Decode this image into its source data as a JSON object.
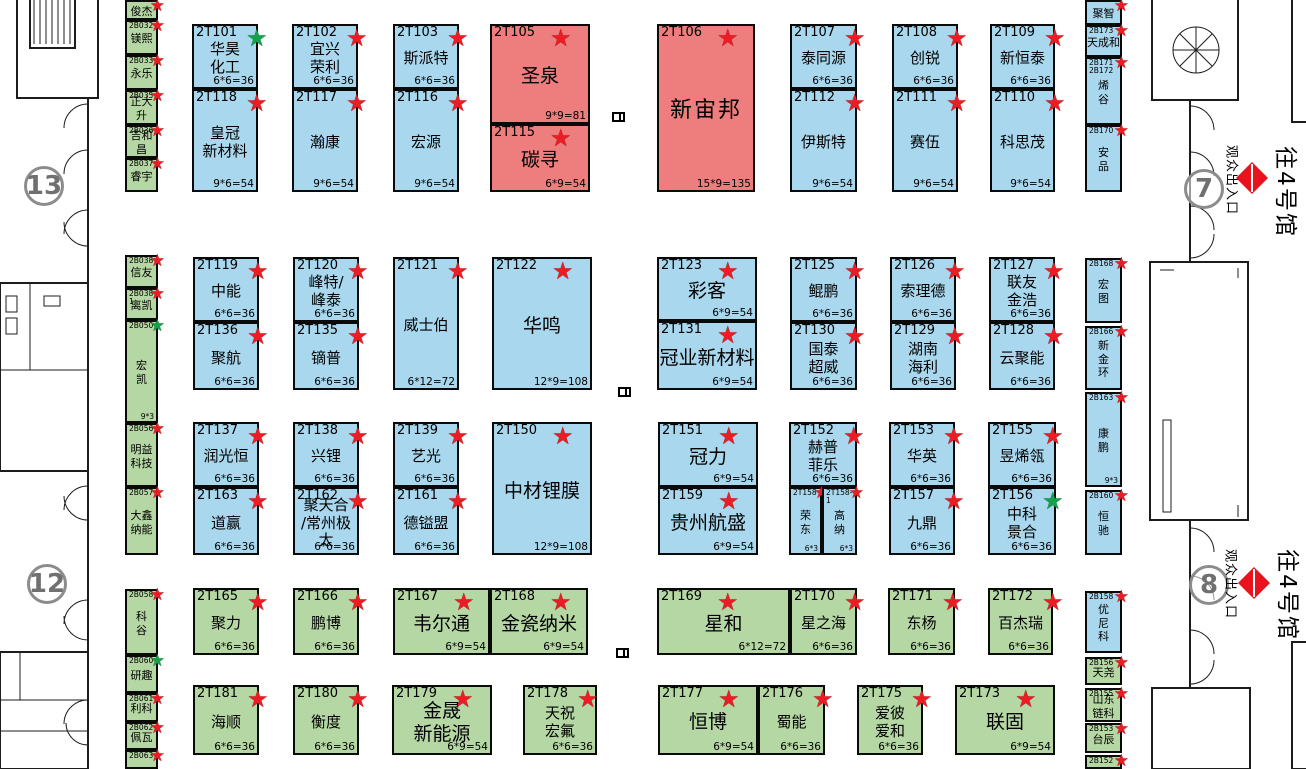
{
  "colors": {
    "booth_blue": "#a9d8ee",
    "booth_red": "#ee7d7d",
    "booth_green": "#b5d7a4",
    "star_red": "#ed1c24",
    "star_green": "#13a24a",
    "wall": "#1c1c1c",
    "gate_gray": "#8c8c8c",
    "exit_diamond_red": "#e8131d"
  },
  "icons": {
    "star": "★",
    "exit_diamond": "diamond-with-line",
    "pillar": "column-marker"
  },
  "labels": {
    "exit": "观众出入口",
    "hall": "往4号馆"
  },
  "gates": [
    {
      "num": "13",
      "cx": 44,
      "cy": 186
    },
    {
      "num": "12",
      "cx": 47,
      "cy": 584
    },
    {
      "num": "7",
      "cx": 1204,
      "cy": 189,
      "exit": true,
      "exit_cx": 1233,
      "exit_cy": 180,
      "dia_cx": 1252,
      "dia_cy": 178,
      "hall_cx": 1288,
      "hall_cy": 192
    },
    {
      "num": "8",
      "cx": 1209,
      "cy": 585,
      "exit": true,
      "exit_cx": 1232,
      "exit_cy": 584,
      "dia_cx": 1254,
      "dia_cy": 583,
      "hall_cx": 1290,
      "hall_cy": 595
    }
  ],
  "pillars": [
    {
      "x": 612,
      "y": 112
    },
    {
      "x": 618,
      "y": 387
    },
    {
      "x": 616,
      "y": 648
    }
  ],
  "booths": [
    {
      "id": "2T101",
      "name": "华昊\n化工",
      "size": "6*6=36",
      "color": "blue",
      "star": "green",
      "x": 192,
      "y": 24,
      "w": 66,
      "h": 65
    },
    {
      "id": "2T118",
      "name": "皇冠\n新材料",
      "size": "9*6=54",
      "color": "blue",
      "star": "red",
      "x": 192,
      "y": 89,
      "w": 66,
      "h": 103
    },
    {
      "id": "2T102",
      "name": "宜兴\n荣利",
      "size": "6*6=36",
      "color": "blue",
      "star": "red",
      "x": 292,
      "y": 24,
      "w": 66,
      "h": 65
    },
    {
      "id": "2T117",
      "name": "瀚康",
      "size": "9*6=54",
      "color": "blue",
      "star": "red",
      "x": 292,
      "y": 89,
      "w": 66,
      "h": 103
    },
    {
      "id": "2T103",
      "name": "斯派特",
      "size": "6*6=36",
      "color": "blue",
      "star": "red",
      "x": 393,
      "y": 24,
      "w": 66,
      "h": 65
    },
    {
      "id": "2T116",
      "name": "宏源",
      "size": "9*6=54",
      "color": "blue",
      "star": "red",
      "x": 393,
      "y": 89,
      "w": 66,
      "h": 103
    },
    {
      "id": "2T105",
      "name": "圣泉",
      "size": "9*9=81",
      "color": "red",
      "star": "red",
      "x": 490,
      "y": 24,
      "w": 100,
      "h": 100
    },
    {
      "id": "2T115",
      "name": "碳寻",
      "size": "6*9=54",
      "color": "red",
      "star": "red",
      "x": 490,
      "y": 124,
      "w": 100,
      "h": 68
    },
    {
      "id": "2T106",
      "name": "新宙邦",
      "size": "15*9=135",
      "color": "red",
      "star": "red",
      "x": 657,
      "y": 24,
      "w": 98,
      "h": 168
    },
    {
      "id": "2T107",
      "name": "泰同源",
      "size": "6*6=36",
      "color": "blue",
      "star": "red",
      "x": 790,
      "y": 24,
      "w": 67,
      "h": 65
    },
    {
      "id": "2T112",
      "name": "伊斯特",
      "size": "9*6=54",
      "color": "blue",
      "star": "red",
      "x": 790,
      "y": 89,
      "w": 67,
      "h": 103
    },
    {
      "id": "2T108",
      "name": "创锐",
      "size": "6*6=36",
      "color": "blue",
      "star": "red",
      "x": 892,
      "y": 24,
      "w": 66,
      "h": 65
    },
    {
      "id": "2T111",
      "name": "赛伍",
      "size": "9*6=54",
      "color": "blue",
      "star": "red",
      "x": 892,
      "y": 89,
      "w": 66,
      "h": 103
    },
    {
      "id": "2T109",
      "name": "新恒泰",
      "size": "6*6=36",
      "color": "blue",
      "star": "red",
      "x": 990,
      "y": 24,
      "w": 65,
      "h": 65
    },
    {
      "id": "2T110",
      "name": "科思茂",
      "size": "9*6=54",
      "color": "blue",
      "star": "red",
      "x": 990,
      "y": 89,
      "w": 65,
      "h": 103
    },
    {
      "id": "2T119",
      "name": "中能",
      "size": "6*6=36",
      "color": "blue",
      "star": "red",
      "x": 193,
      "y": 257,
      "w": 66,
      "h": 65
    },
    {
      "id": "2T136",
      "name": "聚航",
      "size": "6*6=36",
      "color": "blue",
      "star": "red",
      "x": 193,
      "y": 322,
      "w": 66,
      "h": 68
    },
    {
      "id": "2T120",
      "name": "峰特/\n峰泰",
      "size": "6*6=36",
      "color": "blue",
      "star": "red",
      "x": 293,
      "y": 257,
      "w": 66,
      "h": 65
    },
    {
      "id": "2T135",
      "name": "镝普",
      "size": "6*6=36",
      "color": "blue",
      "star": "red",
      "x": 293,
      "y": 322,
      "w": 66,
      "h": 68
    },
    {
      "id": "2T121",
      "name": "威士伯",
      "size": "6*12=72",
      "color": "blue",
      "star": "red",
      "x": 393,
      "y": 257,
      "w": 66,
      "h": 133
    },
    {
      "id": "2T122",
      "name": "华鸣",
      "size": "12*9=108",
      "color": "blue",
      "star": "red",
      "x": 492,
      "y": 257,
      "w": 100,
      "h": 133
    },
    {
      "id": "2T123",
      "name": "彩客",
      "size": "6*9=54",
      "color": "blue",
      "star": "red",
      "x": 657,
      "y": 257,
      "w": 100,
      "h": 64
    },
    {
      "id": "2T131",
      "name": "冠业新材料",
      "size": "6*9=54",
      "color": "blue",
      "star": "red",
      "x": 657,
      "y": 321,
      "w": 100,
      "h": 69
    },
    {
      "id": "2T125",
      "name": "鲲鹏",
      "size": "6*6=36",
      "color": "blue",
      "star": "red",
      "x": 790,
      "y": 257,
      "w": 67,
      "h": 65
    },
    {
      "id": "2T130",
      "name": "国泰\n超威",
      "size": "6*6=36",
      "color": "blue",
      "star": "red",
      "x": 790,
      "y": 322,
      "w": 67,
      "h": 68
    },
    {
      "id": "2T126",
      "name": "索理德",
      "size": "6*6=36",
      "color": "blue",
      "star": "red",
      "x": 890,
      "y": 257,
      "w": 66,
      "h": 65
    },
    {
      "id": "2T129",
      "name": "湖南\n海利",
      "size": "6*6=36",
      "color": "blue",
      "star": "red",
      "x": 890,
      "y": 322,
      "w": 66,
      "h": 68
    },
    {
      "id": "2T127",
      "name": "联友\n金浩",
      "size": "6*6=36",
      "color": "blue",
      "star": "red",
      "x": 989,
      "y": 257,
      "w": 66,
      "h": 65
    },
    {
      "id": "2T128",
      "name": "云聚能",
      "size": "6*6=36",
      "color": "blue",
      "star": "red",
      "x": 989,
      "y": 322,
      "w": 66,
      "h": 68
    },
    {
      "id": "2T137",
      "name": "润光恒",
      "size": "6*6=36",
      "color": "blue",
      "star": "red",
      "x": 193,
      "y": 422,
      "w": 66,
      "h": 65
    },
    {
      "id": "2T163",
      "name": "道赢",
      "size": "6*6=36",
      "color": "blue",
      "star": "red",
      "x": 193,
      "y": 487,
      "w": 66,
      "h": 68
    },
    {
      "id": "2T138",
      "name": "兴锂",
      "size": "6*6=36",
      "color": "blue",
      "star": "red",
      "x": 293,
      "y": 422,
      "w": 66,
      "h": 65
    },
    {
      "id": "2T162",
      "name": "聚天合\n/常州极太",
      "size": "6*6=36",
      "color": "blue",
      "star": "red",
      "x": 293,
      "y": 487,
      "w": 66,
      "h": 68
    },
    {
      "id": "2T139",
      "name": "艺光",
      "size": "6*6=36",
      "color": "blue",
      "star": "red",
      "x": 393,
      "y": 422,
      "w": 66,
      "h": 65
    },
    {
      "id": "2T161",
      "name": "德镒盟",
      "size": "6*6=36",
      "color": "blue",
      "star": "red",
      "x": 393,
      "y": 487,
      "w": 66,
      "h": 68
    },
    {
      "id": "2T150",
      "name": "中材锂膜",
      "size": "12*9=108",
      "color": "blue",
      "star": "red",
      "x": 492,
      "y": 422,
      "w": 100,
      "h": 133
    },
    {
      "id": "2T151",
      "name": "冠力",
      "size": "6*9=54",
      "color": "blue",
      "star": "red",
      "x": 658,
      "y": 422,
      "w": 100,
      "h": 65
    },
    {
      "id": "2T159",
      "name": "贵州航盛",
      "size": "6*9=54",
      "color": "blue",
      "star": "red",
      "x": 658,
      "y": 487,
      "w": 100,
      "h": 68
    },
    {
      "id": "2T152",
      "name": "赫普\n菲乐",
      "size": "6*6=36",
      "color": "blue",
      "star": "red",
      "x": 789,
      "y": 422,
      "w": 68,
      "h": 65
    },
    {
      "id": "2T158",
      "name": "荣\n东",
      "size": "6*3",
      "color": "blue",
      "star": "red",
      "x": 789,
      "y": 487,
      "w": 33,
      "h": 68
    },
    {
      "id": "2T158-1",
      "name": "高\n纳",
      "size": "6*3",
      "color": "blue",
      "star": "red",
      "x": 822,
      "y": 487,
      "w": 35,
      "h": 68
    },
    {
      "id": "2T153",
      "name": "华英",
      "size": "6*6=36",
      "color": "blue",
      "star": "red",
      "x": 889,
      "y": 422,
      "w": 66,
      "h": 65
    },
    {
      "id": "2T157",
      "name": "九鼎",
      "size": "6*6=36",
      "color": "blue",
      "star": "red",
      "x": 889,
      "y": 487,
      "w": 66,
      "h": 68
    },
    {
      "id": "2T155",
      "name": "昱烯瓴",
      "size": "6*6=36",
      "color": "blue",
      "star": "red",
      "x": 988,
      "y": 422,
      "w": 68,
      "h": 65
    },
    {
      "id": "2T156",
      "name": "中科\n景合",
      "size": "6*6=36",
      "color": "blue",
      "star": "green",
      "x": 988,
      "y": 487,
      "w": 68,
      "h": 68
    },
    {
      "id": "2T165",
      "name": "聚力",
      "size": "6*6=36",
      "color": "green",
      "star": "red",
      "x": 193,
      "y": 588,
      "w": 66,
      "h": 67
    },
    {
      "id": "2T166",
      "name": "鹏博",
      "size": "6*6=36",
      "color": "green",
      "star": "red",
      "x": 293,
      "y": 588,
      "w": 66,
      "h": 67
    },
    {
      "id": "2T167",
      "name": "韦尔通",
      "size": "6*9=54",
      "color": "green",
      "star": "red",
      "x": 393,
      "y": 588,
      "w": 97,
      "h": 67
    },
    {
      "id": "2T168",
      "name": "金瓷纳米",
      "size": "6*9=54",
      "color": "green",
      "star": "red",
      "x": 490,
      "y": 588,
      "w": 98,
      "h": 67
    },
    {
      "id": "2T169",
      "name": "星和",
      "size": "6*12=72",
      "color": "green",
      "star": "red",
      "x": 657,
      "y": 588,
      "w": 133,
      "h": 67
    },
    {
      "id": "2T170",
      "name": "星之海",
      "size": "6*6=36",
      "color": "green",
      "star": "red",
      "x": 790,
      "y": 588,
      "w": 67,
      "h": 67
    },
    {
      "id": "2T171",
      "name": "东杨",
      "size": "6*6=36",
      "color": "green",
      "star": "red",
      "x": 888,
      "y": 588,
      "w": 67,
      "h": 67
    },
    {
      "id": "2T172",
      "name": "百杰瑞",
      "size": "6*6=36",
      "color": "green",
      "star": "red",
      "x": 988,
      "y": 588,
      "w": 65,
      "h": 67
    },
    {
      "id": "2T181",
      "name": "海顺",
      "size": "6*6=36",
      "color": "green",
      "star": "red",
      "x": 193,
      "y": 685,
      "w": 66,
      "h": 70
    },
    {
      "id": "2T180",
      "name": "衡度",
      "size": "6*6=36",
      "color": "green",
      "star": "red",
      "x": 293,
      "y": 685,
      "w": 66,
      "h": 70
    },
    {
      "id": "2T179",
      "name": "金晟\n新能源",
      "size": "6*9=54",
      "color": "green",
      "star": "red",
      "x": 392,
      "y": 685,
      "w": 100,
      "h": 70
    },
    {
      "id": "2T178",
      "name": "天祝\n宏氟",
      "size": "6*6=36",
      "color": "green",
      "star": "red",
      "x": 523,
      "y": 685,
      "w": 74,
      "h": 70
    },
    {
      "id": "2T177",
      "name": "恒博",
      "size": "6*9=54",
      "color": "green",
      "star": "red",
      "x": 658,
      "y": 685,
      "w": 100,
      "h": 70
    },
    {
      "id": "2T176",
      "name": "蜀能",
      "size": "6*6=36",
      "color": "green",
      "star": "red",
      "x": 758,
      "y": 685,
      "w": 67,
      "h": 70
    },
    {
      "id": "2T175",
      "name": "爱彼\n爱和",
      "size": "6*6=36",
      "color": "green",
      "star": "red",
      "x": 857,
      "y": 685,
      "w": 66,
      "h": 70
    },
    {
      "id": "2T173",
      "name": "联固",
      "size": "6*9=54",
      "color": "green",
      "star": "red",
      "x": 955,
      "y": 685,
      "w": 100,
      "h": 70
    },
    {
      "id": "",
      "name": "俊杰",
      "size": "",
      "color": "green",
      "star": "red",
      "x": 125,
      "y": 0,
      "w": 33,
      "h": 20
    },
    {
      "id": "2B032",
      "name": "镁熙",
      "size": "",
      "color": "green",
      "star": "red",
      "x": 125,
      "y": 20,
      "w": 33,
      "h": 35
    },
    {
      "id": "2B033",
      "name": "永乐",
      "size": "",
      "color": "green",
      "star": "red",
      "x": 125,
      "y": 55,
      "w": 33,
      "h": 35
    },
    {
      "id": "2B035",
      "name": "正大升",
      "size": "",
      "color": "green",
      "star": "red",
      "x": 125,
      "y": 90,
      "w": 33,
      "h": 35
    },
    {
      "id": "2B036",
      "name": "吉和昌",
      "size": "",
      "color": "green",
      "star": "red",
      "x": 125,
      "y": 125,
      "w": 33,
      "h": 33
    },
    {
      "id": "2B037",
      "name": "睿宇",
      "size": "",
      "color": "green",
      "star": "red",
      "x": 125,
      "y": 158,
      "w": 33,
      "h": 34
    },
    {
      "id": "2B038",
      "name": "信友",
      "size": "",
      "color": "green",
      "star": "red",
      "x": 125,
      "y": 255,
      "w": 33,
      "h": 33
    },
    {
      "id": "2B038-1",
      "name": "离凯",
      "size": "",
      "color": "green",
      "star": "red",
      "x": 125,
      "y": 288,
      "w": 33,
      "h": 32
    },
    {
      "id": "2B050",
      "name": "宏\n凯",
      "size": "9*3",
      "color": "green",
      "star": "green",
      "x": 125,
      "y": 320,
      "w": 33,
      "h": 103
    },
    {
      "id": "2B056",
      "name": "明益\n科技",
      "size": "",
      "color": "green",
      "star": "red",
      "x": 125,
      "y": 423,
      "w": 33,
      "h": 64
    },
    {
      "id": "2B057",
      "name": "大鑫\n纳能",
      "size": "",
      "color": "green",
      "star": "red",
      "x": 125,
      "y": 487,
      "w": 33,
      "h": 68
    },
    {
      "id": "2B058",
      "name": "科\n谷",
      "size": "",
      "color": "green",
      "star": "red",
      "x": 125,
      "y": 589,
      "w": 33,
      "h": 66
    },
    {
      "id": "2B060",
      "name": "研趣",
      "size": "",
      "color": "green",
      "star": "green",
      "x": 125,
      "y": 655,
      "w": 33,
      "h": 38
    },
    {
      "id": "2B061",
      "name": "利科",
      "size": "",
      "color": "green",
      "star": "red",
      "x": 125,
      "y": 693,
      "w": 33,
      "h": 29
    },
    {
      "id": "2B062",
      "name": "佩瓦",
      "size": "",
      "color": "green",
      "star": "red",
      "x": 125,
      "y": 722,
      "w": 33,
      "h": 28
    },
    {
      "id": "2B063",
      "name": "",
      "size": "",
      "color": "green",
      "star": "red",
      "x": 125,
      "y": 750,
      "w": 33,
      "h": 19
    },
    {
      "id": "",
      "name": "聚智",
      "size": "",
      "color": "blue",
      "star": "red",
      "x": 1085,
      "y": 0,
      "w": 37,
      "h": 25
    },
    {
      "id": "2B173",
      "name": "天成和",
      "size": "",
      "color": "blue",
      "star": "red",
      "x": 1085,
      "y": 25,
      "w": 37,
      "h": 32
    },
    {
      "id": "2B171\n2B172",
      "name": "烯\n谷",
      "size": "",
      "color": "blue",
      "star": "red",
      "x": 1085,
      "y": 57,
      "w": 37,
      "h": 68
    },
    {
      "id": "2B170",
      "name": "安\n品",
      "size": "",
      "color": "blue",
      "star": "red",
      "x": 1085,
      "y": 125,
      "w": 37,
      "h": 67
    },
    {
      "id": "2B168",
      "name": "宏\n图",
      "size": "",
      "color": "blue",
      "star": "red",
      "x": 1085,
      "y": 258,
      "w": 37,
      "h": 65
    },
    {
      "id": "2B166",
      "name": "新\n金\n环",
      "size": "",
      "color": "blue",
      "star": "red",
      "x": 1085,
      "y": 326,
      "w": 37,
      "h": 64
    },
    {
      "id": "2B163",
      "name": "康\n鹏",
      "size": "9*3",
      "color": "blue",
      "star": "red",
      "x": 1085,
      "y": 392,
      "w": 37,
      "h": 95
    },
    {
      "id": "2B160",
      "name": "恒\n驰",
      "size": "",
      "color": "blue",
      "star": "red",
      "x": 1085,
      "y": 490,
      "w": 37,
      "h": 65
    },
    {
      "id": "2B158",
      "name": "优\n尼\n科",
      "size": "",
      "color": "blue",
      "star": "red",
      "x": 1085,
      "y": 591,
      "w": 37,
      "h": 62
    },
    {
      "id": "2B156",
      "name": "天尧",
      "size": "",
      "color": "green",
      "star": "red",
      "x": 1085,
      "y": 657,
      "w": 37,
      "h": 28
    },
    {
      "id": "2B155",
      "name": "山东\n链科",
      "size": "",
      "color": "green",
      "star": "red",
      "x": 1085,
      "y": 688,
      "w": 37,
      "h": 34
    },
    {
      "id": "2B153",
      "name": "台辰",
      "size": "",
      "color": "green",
      "star": "red",
      "x": 1085,
      "y": 723,
      "w": 37,
      "h": 30
    },
    {
      "id": "2B152",
      "name": "",
      "size": "",
      "color": "green",
      "star": "red",
      "x": 1085,
      "y": 755,
      "w": 37,
      "h": 14
    }
  ]
}
